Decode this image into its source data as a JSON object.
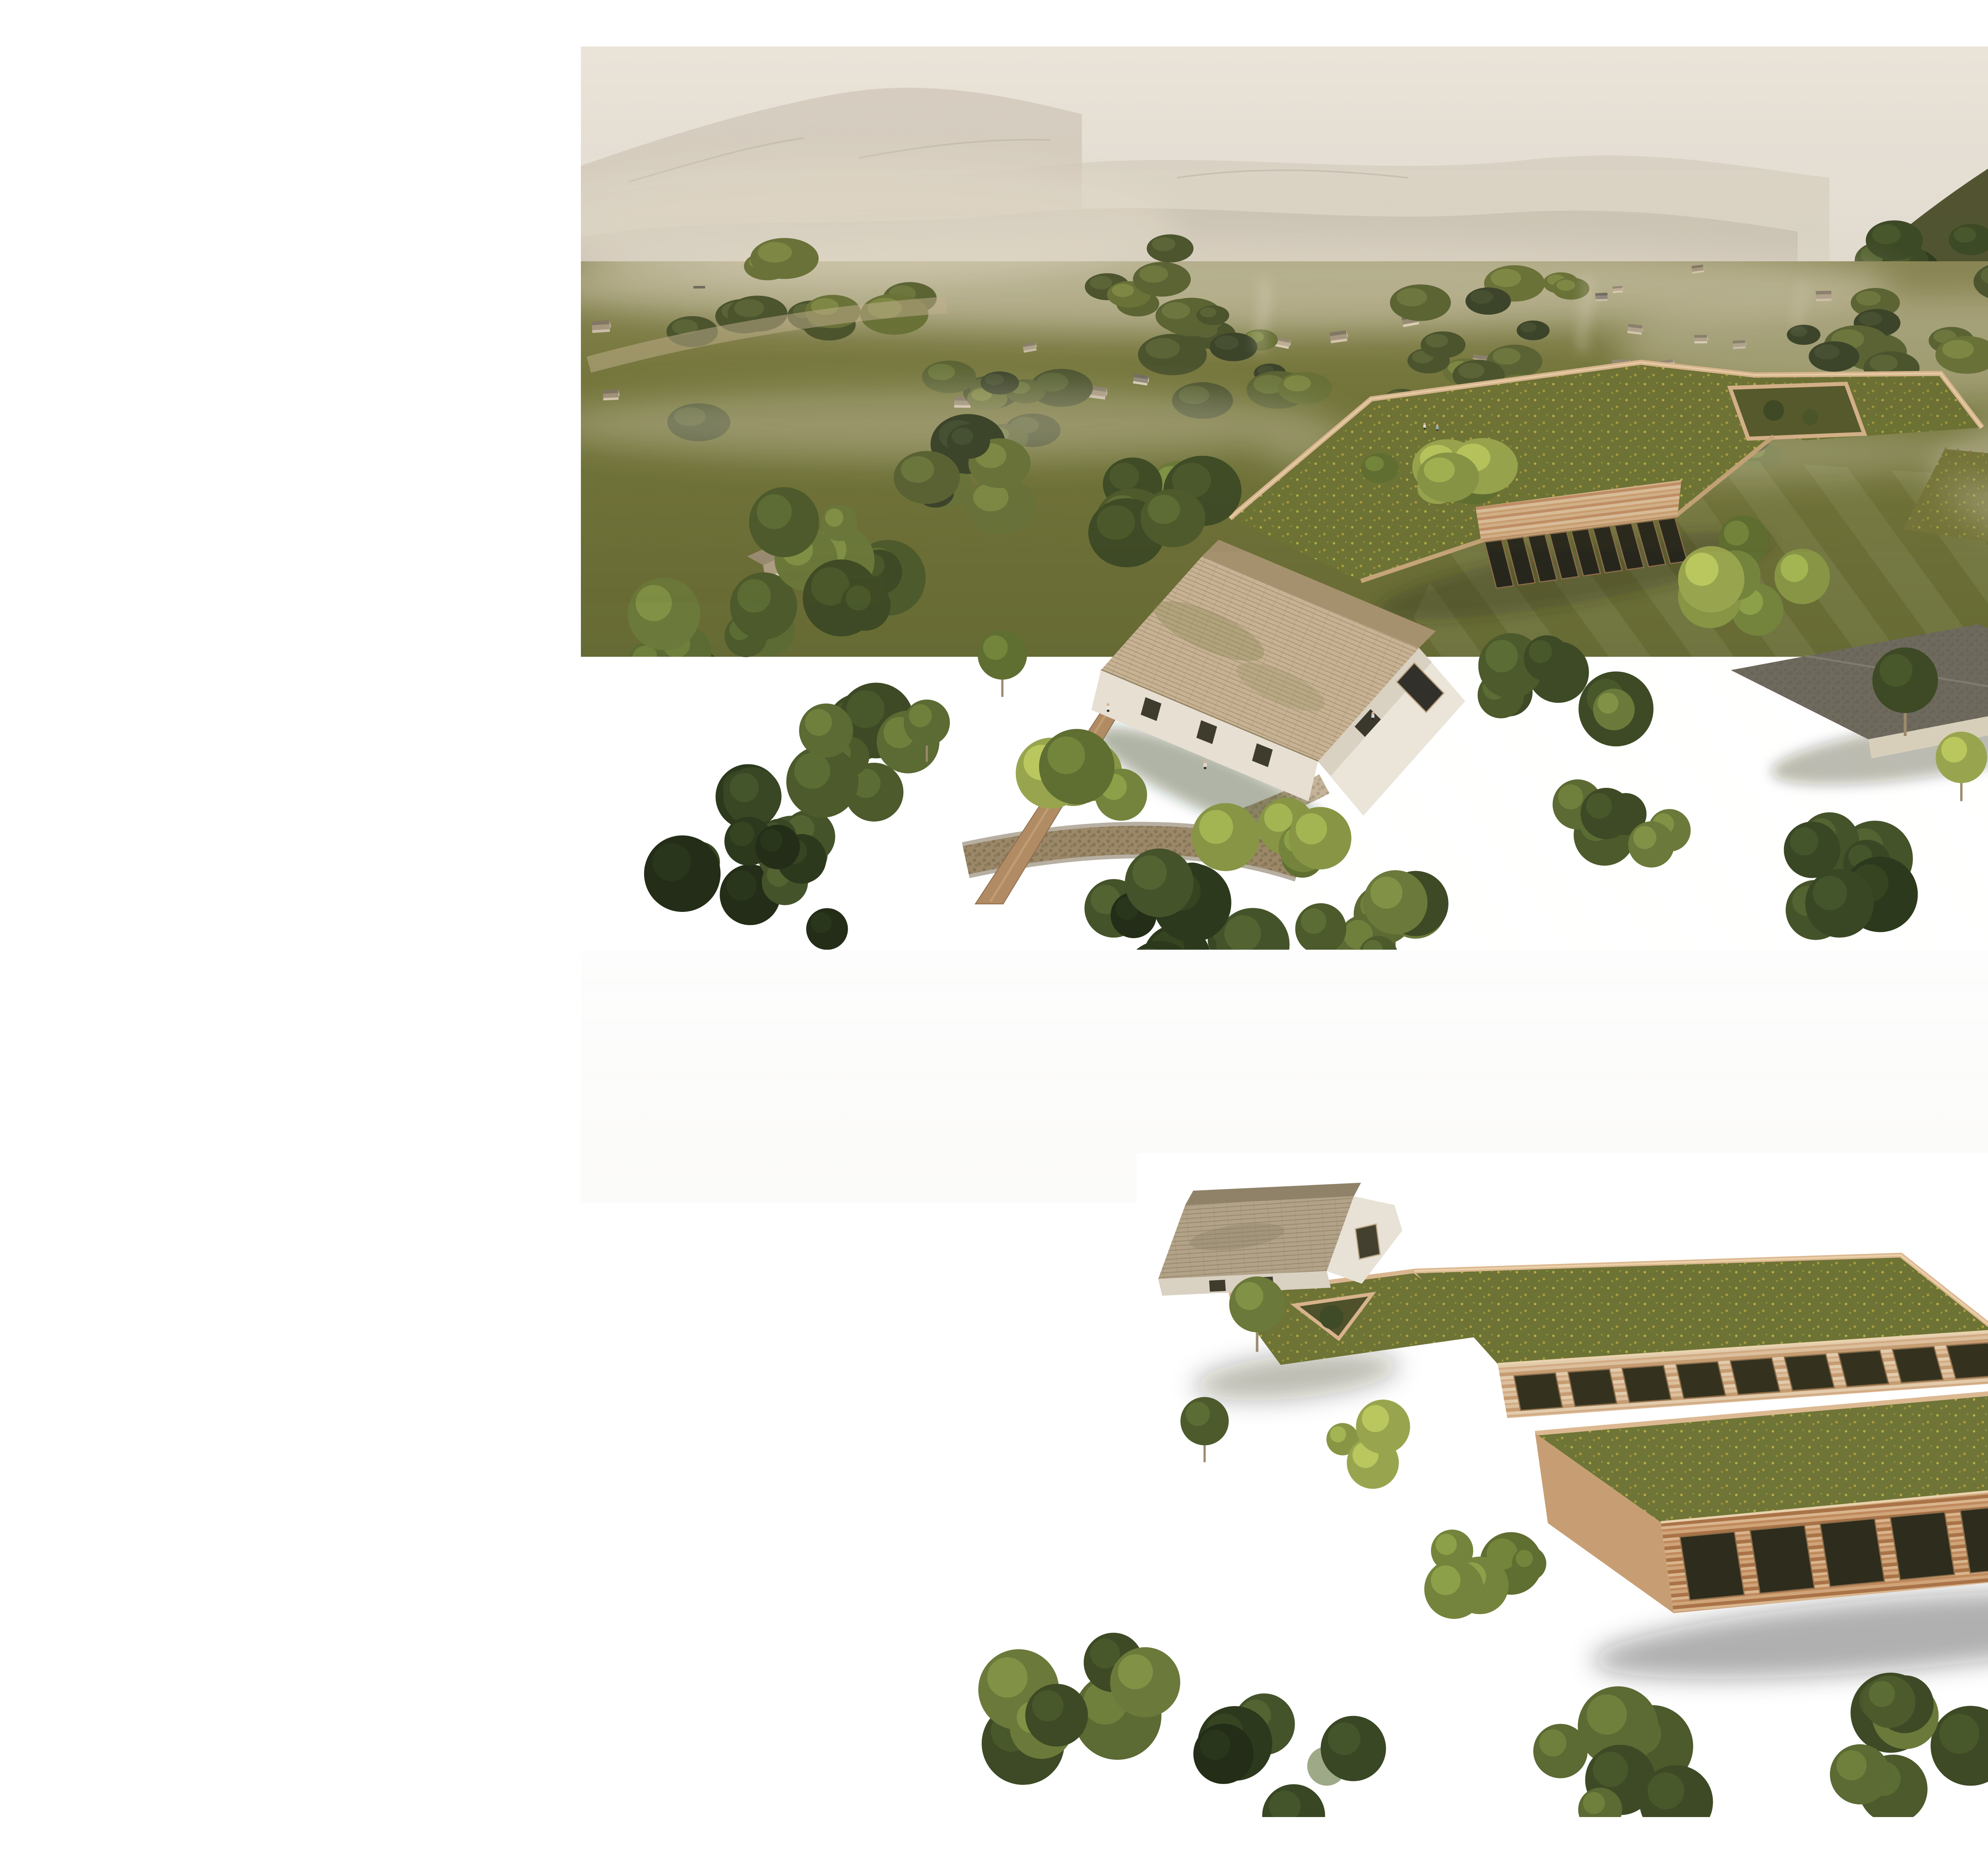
{
  "document": {
    "type": "architectural presentation board",
    "background": "#ffffff"
  },
  "header": {
    "title": "CENTRU DE ÎNGRIJIRE PENTRU PERSOANELE CU DEMENȚĂ TIP",
    "wordmark_letters": [
      "A",
      "L",
      "Z",
      "H",
      "E",
      "I",
      "M",
      "E",
      "R"
    ]
  },
  "description": "Raportat la pacienții cu Alzheimer, identitatea arhitecturală a centrului reprezintă mai mult decât o structură fizică, ci o extensie a identității pacientului în care spațiul este configurat încât să corespundă nevoilor cognitive și emoționale prin interacțiunea dintre funcționalitate, estetică și simbolism cultural. Perspectiva generală asupra ansamblului evidențiază o strategie de implantare bazată pe discreție și adaptare morfologică la topografia sitului. Volumele parțial îngropate, tratate cu acoperișuri verzi circulabile, asigură o continuitate perceptivă cu peisajul rural, diminuând impactul vizual și favorizând o prezență arhitecturală subtilă și contextuală. Volumul de acces, articulat printr-o morfologie tipologică recognoscibilă, joacă rolul de element mediator între noua intervenție și țesutul construit existent, stabilind un dialog coerent între arhitectura propusă și specificul identitar al peisajului cultural al Cisnădioarei.",
  "palette": {
    "title_gray": "#6b6b6b",
    "body_gray": "#7e7e7e",
    "sky_beige": "#e9e4dc",
    "sky_gray": "#efeeec",
    "meadow_olive": "#6e7338",
    "green_roof": "#6d7335",
    "rammed_earth": "#cfa87f",
    "shingle_roof": "#c3b091",
    "red_roof": "#b0604a"
  }
}
